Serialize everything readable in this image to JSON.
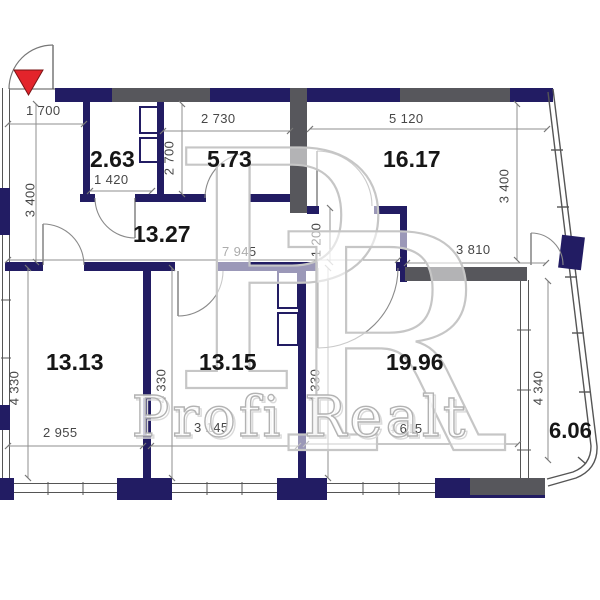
{
  "watermark": {
    "monogram_letters": [
      "P",
      "R"
    ],
    "brand_text": "Profi Realt"
  },
  "entrance": {
    "marker_color": "#e3242b"
  },
  "rooms": [
    {
      "id": "room-a",
      "area": "2.63"
    },
    {
      "id": "room-b",
      "area": "5.73"
    },
    {
      "id": "room-c",
      "area": "16.17"
    },
    {
      "id": "hallway",
      "area": "13.27"
    },
    {
      "id": "room-d",
      "area": "13.13"
    },
    {
      "id": "room-e",
      "area": "13.15"
    },
    {
      "id": "room-f",
      "area": "19.96"
    },
    {
      "id": "balcony",
      "area": "6.06"
    }
  ],
  "dimensions": {
    "entrance_width": "1 700",
    "room_b_width": "2 730",
    "room_c_width": "5 120",
    "room_a_width": "1 420",
    "hallway_length": "7 945",
    "room_f_top_width": "3 810",
    "room_d_width": "2 955",
    "room_e_width": "3 145",
    "room_f_width": "4 615",
    "left_wall_height": "3 400",
    "room_a_height": "2 700",
    "room_c_height": "3 400",
    "corridor_width": "1 200",
    "room_d_height": "4 330",
    "room_e_height_left": "4 330",
    "room_e_height_right": "4 330",
    "balcony_height": "4 340"
  },
  "colors": {
    "wall_primary": "#221c63",
    "wall_secondary": "#57575c",
    "entrance_marker": "#e3242b",
    "watermark": "#c6c6c6"
  }
}
